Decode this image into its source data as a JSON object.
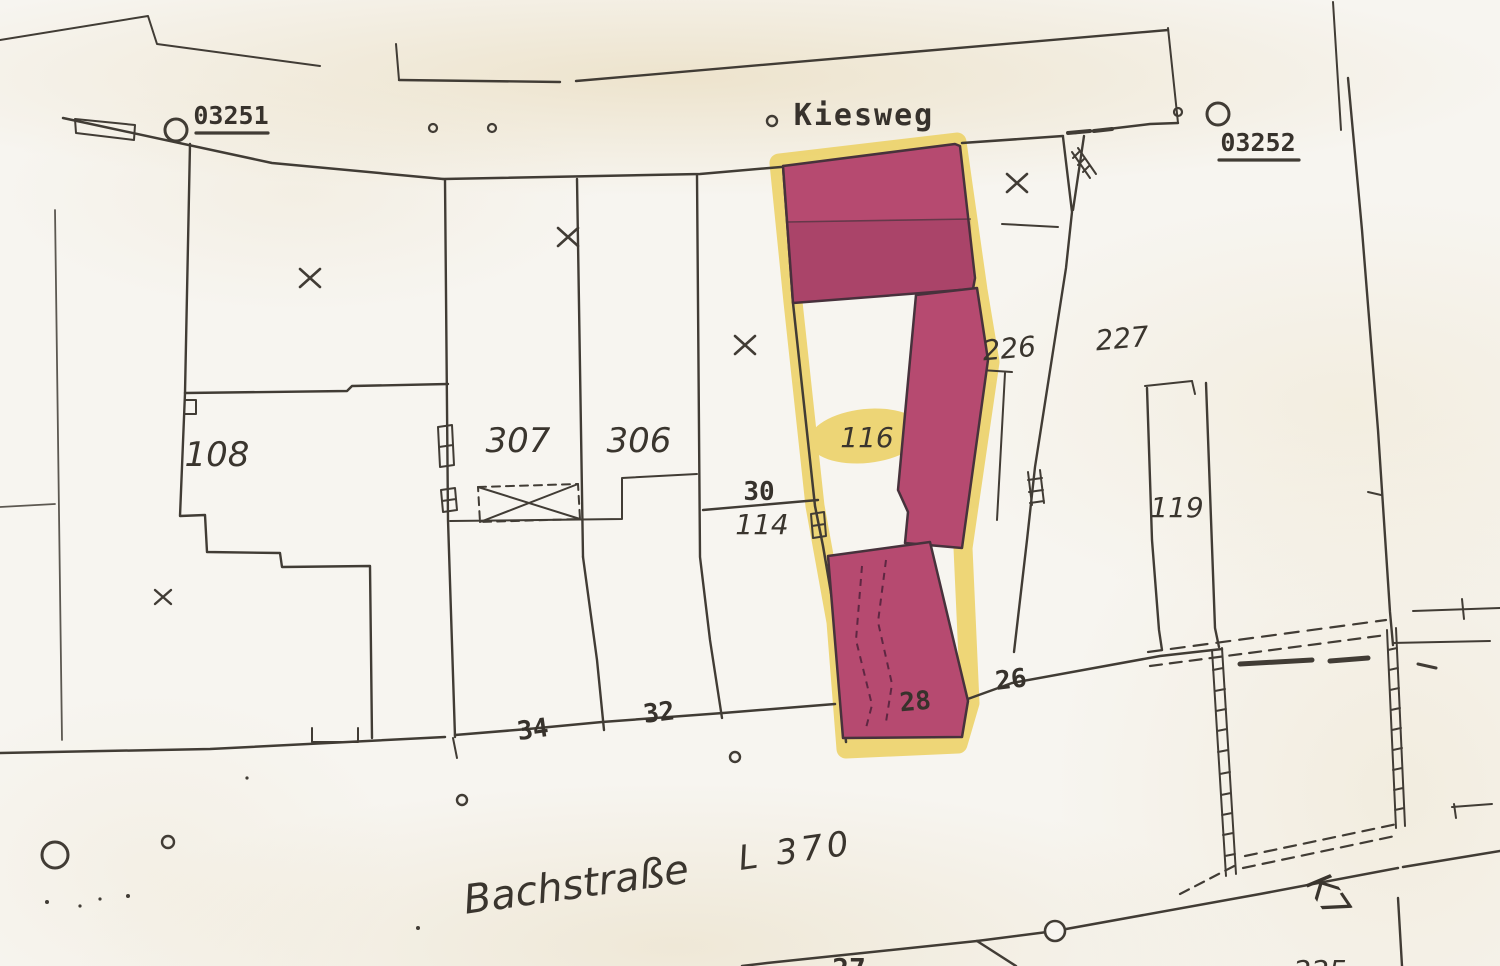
{
  "map": {
    "streets": {
      "kiesweg": "Kiesweg",
      "bachstrasse": "Bachstraße",
      "l_road": "L 370",
      "k_road": "K7"
    },
    "control_points": {
      "cp_left": "03251",
      "cp_right": "03252"
    },
    "parcel_numbers": {
      "p108": "108",
      "p307": "307",
      "p306": "306",
      "p114": "114",
      "p116": "116",
      "p119": "119",
      "p226": "226",
      "p227": "227"
    },
    "house_numbers": {
      "h30": "30",
      "h34": "34",
      "h32": "32",
      "h28": "28",
      "h26": "26"
    },
    "partial_numbers": {
      "h27": "27",
      "p225": "225"
    },
    "colors": {
      "highlight_fill": "#b64a70",
      "highlight_outline": "#eccf5c",
      "ink": "#413c35",
      "paper": "#f7f5f0"
    }
  }
}
